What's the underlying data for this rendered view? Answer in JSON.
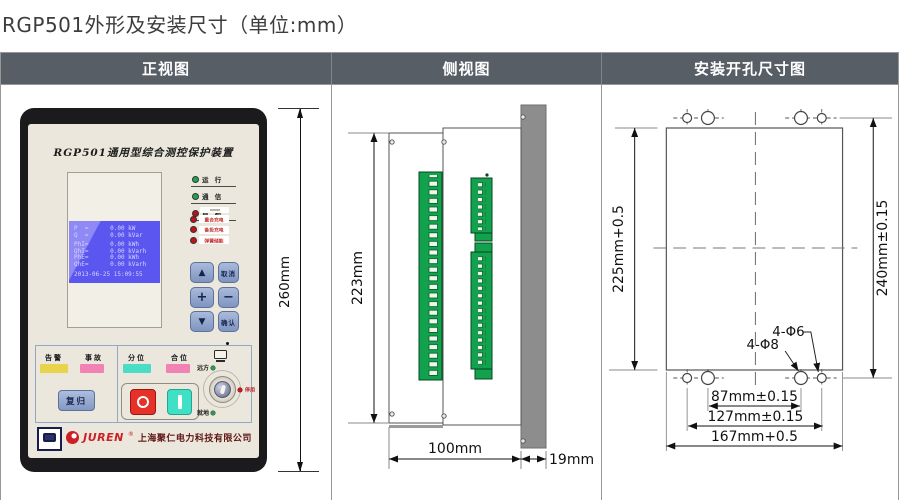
{
  "page_title": "RGP501外形及安装尺寸（单位:mm）",
  "table": {
    "front_header": "正视图",
    "side_header": "侧视图",
    "install_header": "安装开孔尺寸图"
  },
  "front": {
    "model_title": "RGP501通用型综合测控保护装置",
    "lcd_lines": [
      "P  =      0.00 kW",
      "Q  =      0.00 kVar",
      "PhI=      0.00 kWh",
      "QhI=      0.00 kVarh",
      "PhE=      0.00 kWh",
      "QhE=      0.00 kVarh"
    ],
    "lcd_time": "2013-06-25 15:09:55",
    "led_run": "运 行",
    "led_comm": "通 信",
    "led_check": "自 检",
    "led_recharge": "重合充电",
    "led_backup": "备投充电",
    "led_spring": "弹簧储能",
    "btn_up": "▲",
    "btn_cancel": "取消",
    "btn_plus": "+",
    "btn_minus": "−",
    "btn_down": "▼",
    "btn_confirm": "确认",
    "lbl_alarm": "告警",
    "lbl_fault": "事故",
    "lbl_open": "分位",
    "lbl_close": "合位",
    "btn_reset": "复归",
    "sw_remote": "远方",
    "sw_local": "就地",
    "sw_disabled": "停用",
    "brand_name": "JUREN",
    "brand_reg": "®",
    "brand_company": "上海聚仁电力科技有限公司"
  },
  "dims": {
    "front_height": "260mm",
    "side_height": "223mm",
    "side_depth": "100mm",
    "panel_thickness": "19mm",
    "cutout_height": "225mm+0.5",
    "holes_height": "240mm±0.15",
    "holes_inner_span": "87mm±0.15",
    "holes_outer_span": "127mm±0.15",
    "cutout_width": "167mm+0.5",
    "label_d6": "4-Φ6",
    "label_d8": "4-Φ8"
  },
  "colors": {
    "header_bg": "#575e66",
    "lcd_bg": "#5b56ef",
    "keypad_blue": "#8da3c9",
    "open_red": "#e63129",
    "close_cyan": "#3fe0c6",
    "alarm_yellow": "#e7d44b",
    "fault_pink": "#f083b4",
    "terminal_green": "#12a24d",
    "brand_red": "#cc2027",
    "led_green": "#1fa34d",
    "led_red": "#c1121a"
  }
}
